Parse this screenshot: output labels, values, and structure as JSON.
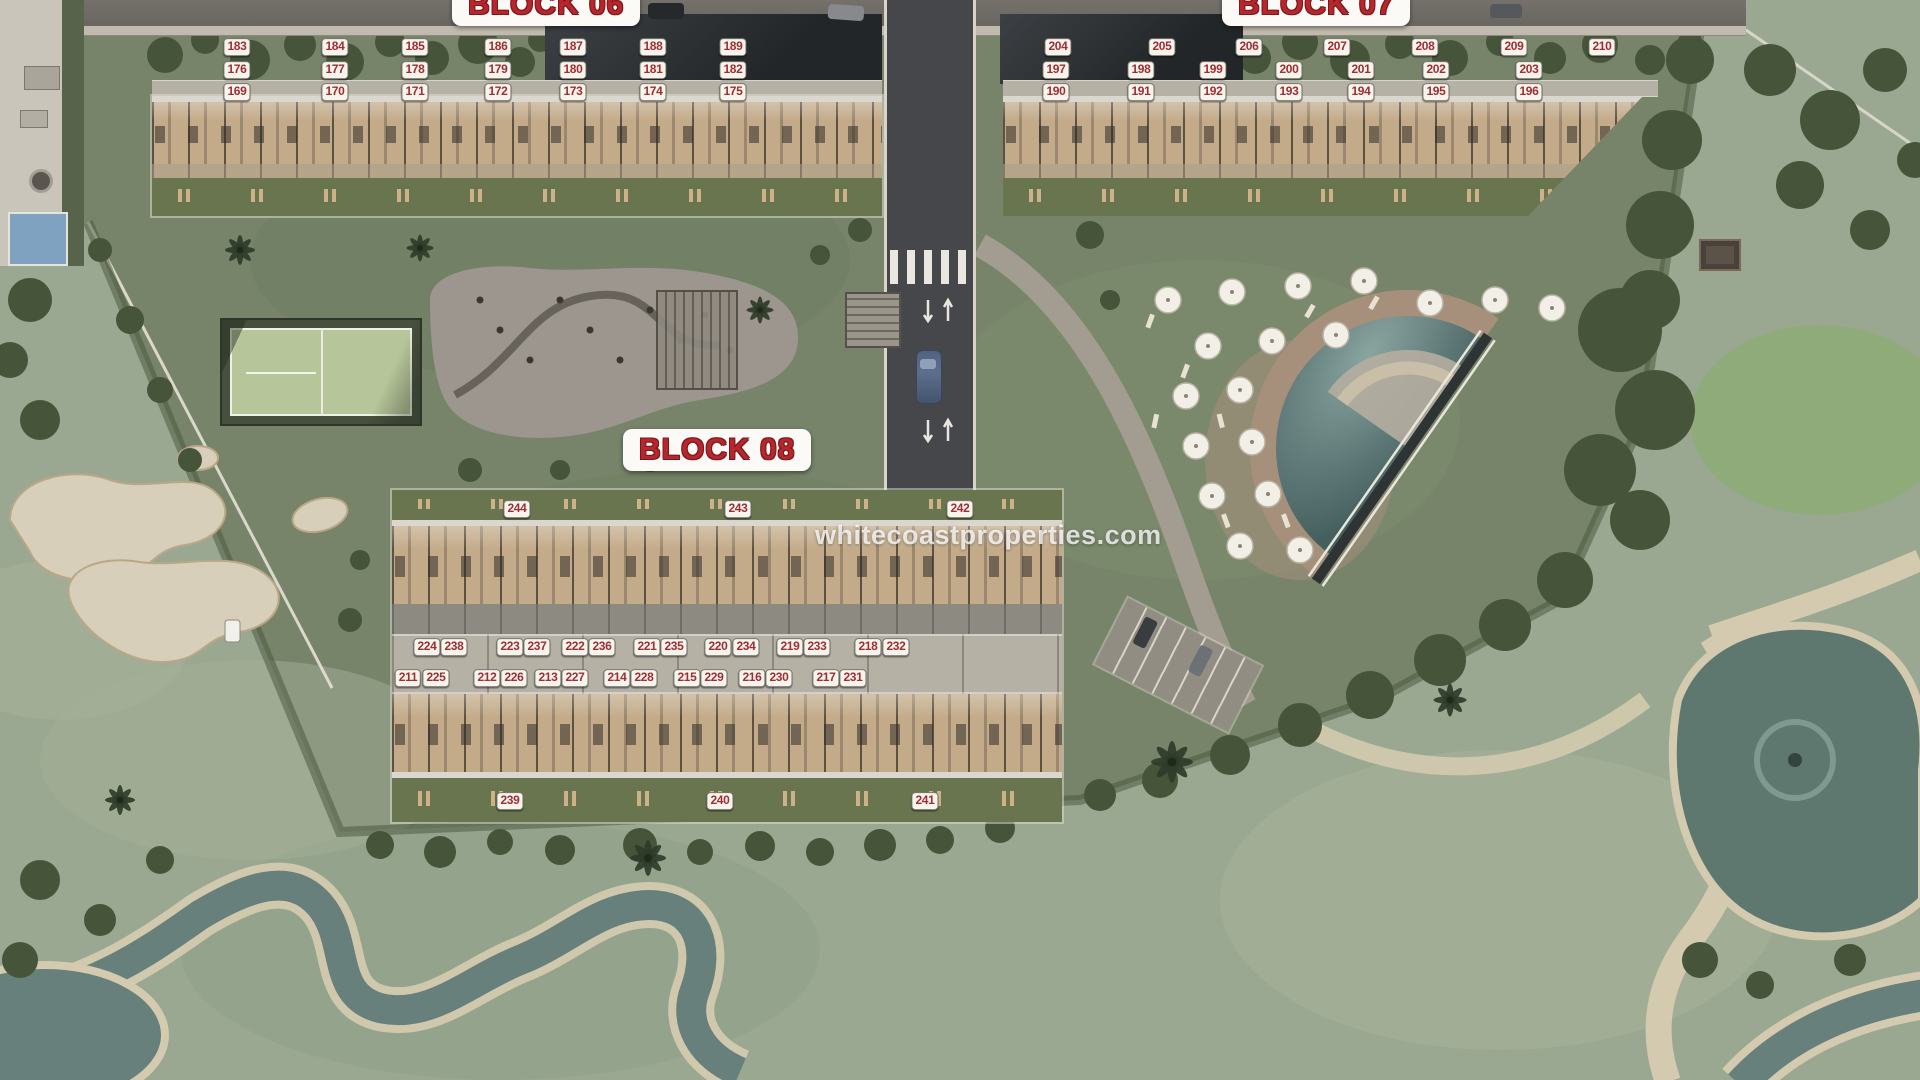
{
  "page": {
    "watermark": "whitecoastproperties.com"
  },
  "theme": {
    "badge_text_color": "#9e2d34",
    "badge_background": "#f7f4ec",
    "label_red": "#b5272d",
    "grass_green": "#77846a",
    "golf_green": "#9aa891",
    "water_teal": "#67807b",
    "sand_cream": "#d3caaf",
    "pool_deck_tan": "#a6907c"
  },
  "blocks": [
    {
      "id": "block-06",
      "label": "BLOCK 06"
    },
    {
      "id": "block-07",
      "label": "BLOCK 07"
    },
    {
      "id": "block-08",
      "label": "BLOCK 08"
    }
  ],
  "unit_badges": [
    {
      "b": "06",
      "n": "183",
      "x": 237,
      "y": 47
    },
    {
      "b": "06",
      "n": "184",
      "x": 335,
      "y": 47
    },
    {
      "b": "06",
      "n": "185",
      "x": 415,
      "y": 47
    },
    {
      "b": "06",
      "n": "186",
      "x": 498,
      "y": 47
    },
    {
      "b": "06",
      "n": "187",
      "x": 573,
      "y": 47
    },
    {
      "b": "06",
      "n": "188",
      "x": 653,
      "y": 47
    },
    {
      "b": "06",
      "n": "189",
      "x": 733,
      "y": 47
    },
    {
      "b": "06",
      "n": "176",
      "x": 237,
      "y": 70
    },
    {
      "b": "06",
      "n": "177",
      "x": 335,
      "y": 70
    },
    {
      "b": "06",
      "n": "178",
      "x": 415,
      "y": 70
    },
    {
      "b": "06",
      "n": "179",
      "x": 498,
      "y": 70
    },
    {
      "b": "06",
      "n": "180",
      "x": 573,
      "y": 70
    },
    {
      "b": "06",
      "n": "181",
      "x": 653,
      "y": 70
    },
    {
      "b": "06",
      "n": "182",
      "x": 733,
      "y": 70
    },
    {
      "b": "06",
      "n": "169",
      "x": 237,
      "y": 92
    },
    {
      "b": "06",
      "n": "170",
      "x": 335,
      "y": 92
    },
    {
      "b": "06",
      "n": "171",
      "x": 415,
      "y": 92
    },
    {
      "b": "06",
      "n": "172",
      "x": 498,
      "y": 92
    },
    {
      "b": "06",
      "n": "173",
      "x": 573,
      "y": 92
    },
    {
      "b": "06",
      "n": "174",
      "x": 653,
      "y": 92
    },
    {
      "b": "06",
      "n": "175",
      "x": 733,
      "y": 92
    },
    {
      "b": "07",
      "n": "204",
      "x": 1058,
      "y": 47
    },
    {
      "b": "07",
      "n": "205",
      "x": 1162,
      "y": 47
    },
    {
      "b": "07",
      "n": "206",
      "x": 1249,
      "y": 47
    },
    {
      "b": "07",
      "n": "207",
      "x": 1337,
      "y": 47
    },
    {
      "b": "07",
      "n": "208",
      "x": 1425,
      "y": 47
    },
    {
      "b": "07",
      "n": "209",
      "x": 1514,
      "y": 47
    },
    {
      "b": "07",
      "n": "210",
      "x": 1602,
      "y": 47
    },
    {
      "b": "07",
      "n": "197",
      "x": 1056,
      "y": 70
    },
    {
      "b": "07",
      "n": "198",
      "x": 1141,
      "y": 70
    },
    {
      "b": "07",
      "n": "199",
      "x": 1213,
      "y": 70
    },
    {
      "b": "07",
      "n": "200",
      "x": 1289,
      "y": 70
    },
    {
      "b": "07",
      "n": "201",
      "x": 1361,
      "y": 70
    },
    {
      "b": "07",
      "n": "202",
      "x": 1436,
      "y": 70
    },
    {
      "b": "07",
      "n": "203",
      "x": 1529,
      "y": 70
    },
    {
      "b": "07",
      "n": "190",
      "x": 1056,
      "y": 92
    },
    {
      "b": "07",
      "n": "191",
      "x": 1141,
      "y": 92
    },
    {
      "b": "07",
      "n": "192",
      "x": 1213,
      "y": 92
    },
    {
      "b": "07",
      "n": "193",
      "x": 1289,
      "y": 92
    },
    {
      "b": "07",
      "n": "194",
      "x": 1361,
      "y": 92
    },
    {
      "b": "07",
      "n": "195",
      "x": 1436,
      "y": 92
    },
    {
      "b": "07",
      "n": "196",
      "x": 1529,
      "y": 92
    },
    {
      "b": "08",
      "n": "244",
      "x": 517,
      "y": 509
    },
    {
      "b": "08",
      "n": "243",
      "x": 738,
      "y": 509
    },
    {
      "b": "08",
      "n": "242",
      "x": 960,
      "y": 509
    },
    {
      "b": "08",
      "n": "224",
      "x": 427,
      "y": 647
    },
    {
      "b": "08",
      "n": "238",
      "x": 454,
      "y": 647
    },
    {
      "b": "08",
      "n": "223",
      "x": 510,
      "y": 647
    },
    {
      "b": "08",
      "n": "237",
      "x": 537,
      "y": 647
    },
    {
      "b": "08",
      "n": "222",
      "x": 575,
      "y": 647
    },
    {
      "b": "08",
      "n": "236",
      "x": 602,
      "y": 647
    },
    {
      "b": "08",
      "n": "221",
      "x": 647,
      "y": 647
    },
    {
      "b": "08",
      "n": "235",
      "x": 674,
      "y": 647
    },
    {
      "b": "08",
      "n": "220",
      "x": 718,
      "y": 647
    },
    {
      "b": "08",
      "n": "234",
      "x": 746,
      "y": 647
    },
    {
      "b": "08",
      "n": "219",
      "x": 790,
      "y": 647
    },
    {
      "b": "08",
      "n": "233",
      "x": 817,
      "y": 647
    },
    {
      "b": "08",
      "n": "218",
      "x": 868,
      "y": 647
    },
    {
      "b": "08",
      "n": "232",
      "x": 896,
      "y": 647
    },
    {
      "b": "08",
      "n": "211",
      "x": 408,
      "y": 678
    },
    {
      "b": "08",
      "n": "225",
      "x": 436,
      "y": 678
    },
    {
      "b": "08",
      "n": "212",
      "x": 487,
      "y": 678
    },
    {
      "b": "08",
      "n": "226",
      "x": 514,
      "y": 678
    },
    {
      "b": "08",
      "n": "213",
      "x": 548,
      "y": 678
    },
    {
      "b": "08",
      "n": "227",
      "x": 575,
      "y": 678
    },
    {
      "b": "08",
      "n": "214",
      "x": 617,
      "y": 678
    },
    {
      "b": "08",
      "n": "228",
      "x": 644,
      "y": 678
    },
    {
      "b": "08",
      "n": "215",
      "x": 687,
      "y": 678
    },
    {
      "b": "08",
      "n": "229",
      "x": 714,
      "y": 678
    },
    {
      "b": "08",
      "n": "216",
      "x": 752,
      "y": 678
    },
    {
      "b": "08",
      "n": "230",
      "x": 779,
      "y": 678
    },
    {
      "b": "08",
      "n": "217",
      "x": 826,
      "y": 678
    },
    {
      "b": "08",
      "n": "231",
      "x": 853,
      "y": 678
    },
    {
      "b": "08",
      "n": "239",
      "x": 510,
      "y": 801
    },
    {
      "b": "08",
      "n": "240",
      "x": 720,
      "y": 801
    },
    {
      "b": "08",
      "n": "241",
      "x": 925,
      "y": 801
    }
  ]
}
